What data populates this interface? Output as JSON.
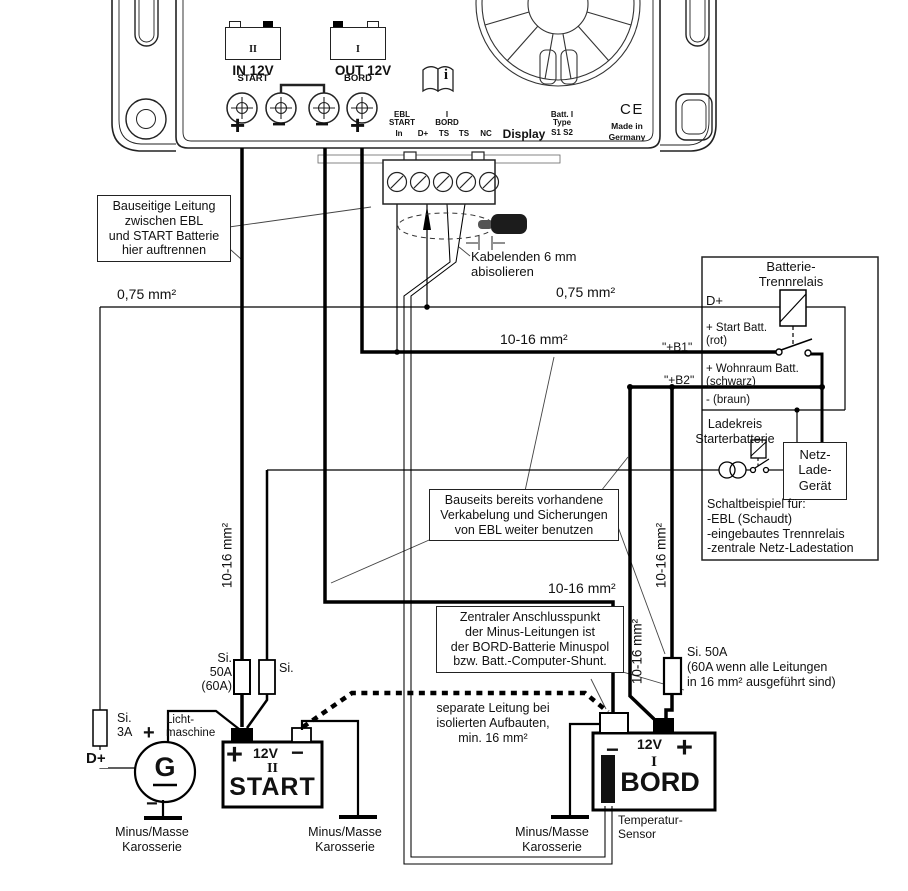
{
  "device": {
    "in_label": "IN 12V",
    "out_label": "OUT 12V",
    "sign1": "+",
    "sign2": "−",
    "sign3": "−",
    "sign4": "+",
    "start_icon": {
      "numeral": "II",
      "name": "START"
    },
    "bord_icon": {
      "numeral": "I",
      "name": "BORD"
    },
    "pins": {
      "ebl": "EBL",
      "start": "START",
      "in_": "In",
      "dplus": "D+",
      "i": "I",
      "bord": "BORD",
      "ts1": "TS",
      "ts2": "TS",
      "nc": "NC",
      "display": "Display",
      "batt": "Batt. I",
      "type": "Type",
      "s1s2": "S1 S2"
    },
    "ce": "CE",
    "made_in": "Made in\nGermany",
    "manual_icon": "i"
  },
  "notes": {
    "bauseitige": "Bauseitige Leitung\nzwischen EBL\nund START Batterie\nhier auftrennen",
    "kabelenden": "Kabelenden 6 mm\nabisolieren",
    "bauseits": "Bauseits bereits vorhandene\nVerkabelung und Sicherungen\nvon EBL weiter benutzen",
    "zentraler": "Zentraler Anschlusspunkt\nder Minus-Leitungen ist\nder BORD-Batterie Minuspol\nbzw. Batt.-Computer-Shunt.",
    "separate": "separate Leitung bei\nisolierten Aufbauten,\nmin. 16 mm²"
  },
  "wire_labels": {
    "w075_left": "0,75 mm²",
    "w075_right": "0,75 mm²",
    "w1016_out": "10-16 mm²",
    "w1016_minus": "10-16 mm²",
    "w1016_v_left": "10-16 mm²",
    "w1016_v_mid": "10-16 mm²",
    "w1016_v_right": "10-16 mm²",
    "b1": "\"+B1\"",
    "b2": "\"+B2\""
  },
  "fuses": {
    "si50a_left": "Si.\n50A\n(60A)",
    "si_small": "Si.",
    "si3a": "Si.\n3A",
    "si50a_right": "Si. 50A\n(60A wenn alle Leitungen\nin 16 mm² ausgeführt sind)"
  },
  "relay_box": {
    "title": "Batterie-\nTrennrelais",
    "dplus": "D+",
    "start_batt": "+ Start Batt.\n(rot)",
    "wohnraum": "+ Wohnraum Batt.\n(schwarz)",
    "braun": "- (braun)",
    "ladekreis": "Ladekreis\nStarterbatterie",
    "nlg": "Netz-\nLade-\nGerät",
    "schaltbeispiel": "Schaltbeispiel für:\n-EBL (Schaudt)\n-eingebautes Trennrelais\n-zentrale Netz-Ladestation"
  },
  "alternator": {
    "dplus": "D+",
    "label": "Licht-\nmaschine",
    "g": "G",
    "plus": "+",
    "minus": "−"
  },
  "batteries": {
    "start": {
      "plus": "+",
      "voltage": "12V",
      "minus": "−",
      "numeral": "II",
      "name": "START"
    },
    "bord": {
      "minus": "−",
      "voltage": "12V",
      "plus": "+",
      "numeral": "I",
      "name": "BORD"
    }
  },
  "grounds": {
    "g1": "Minus/Masse\nKarosserie",
    "g2": "Minus/Masse\nKarosserie",
    "g3": "Minus/Masse\nKarosserie"
  },
  "sensor": {
    "label": "Temperatur-\nSensor"
  }
}
